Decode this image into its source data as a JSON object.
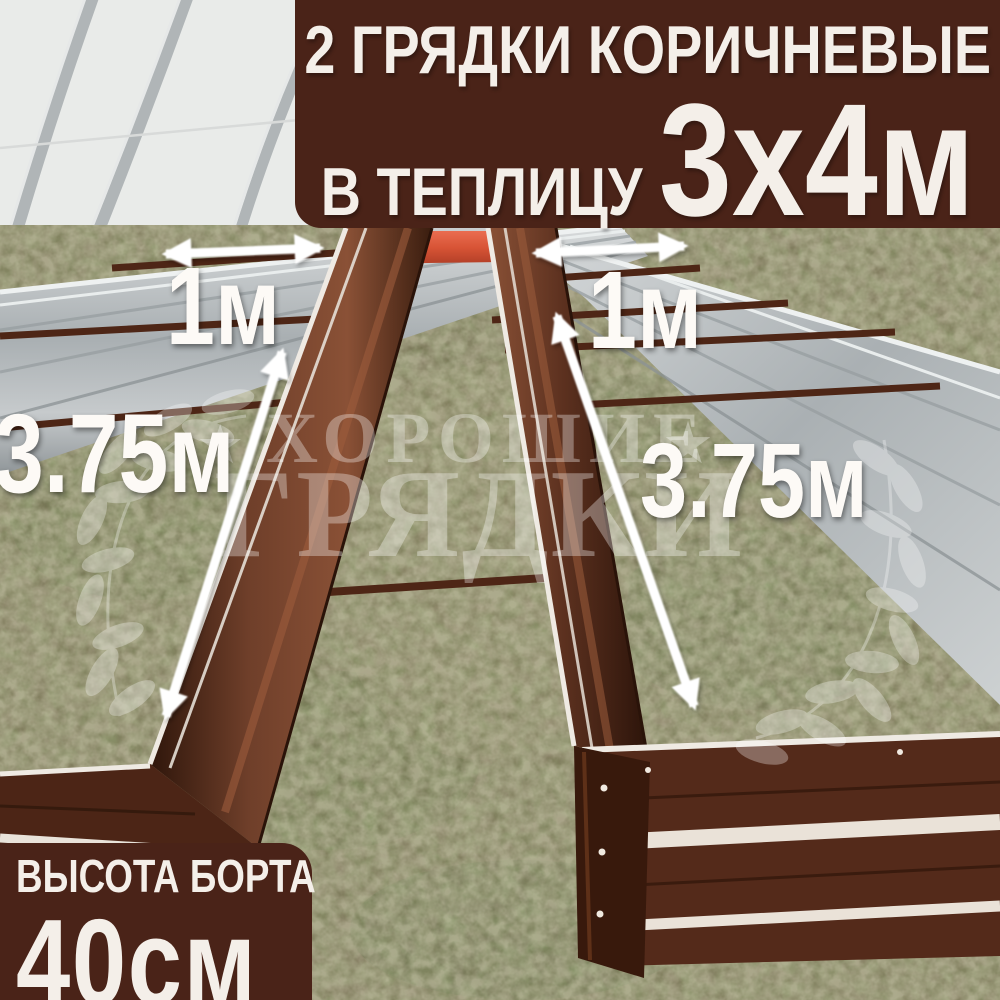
{
  "banner": {
    "line1": "2 ГРЯДКИ КОРИЧНЕВЫЕ",
    "line2_small": "В ТЕПЛИЦУ",
    "line2_big": "3х4м"
  },
  "badge": {
    "title": "ВЫСОТА БОРТА",
    "value": "40см"
  },
  "measurements": {
    "left_bed_width": "1м",
    "right_bed_width": "1м",
    "left_bed_length": "3.75м",
    "right_bed_length": "3.75м"
  },
  "watermark": {
    "word1": "ХОРОШИЕ",
    "word2": "ГРЯДКИ",
    "star": "★"
  },
  "colors": {
    "banner_bg": "#4a2318",
    "banner_text": "#f4efe9",
    "bed_brown_dark": "#572a1c",
    "bed_brown_highlight": "#7c4831",
    "bed_rail_white": "#efeae3",
    "orange_end_board": "#d85436",
    "galvanized_metal": "#b7bcbe",
    "greenhouse_wall": "#e9ebe9",
    "ground_green": "#6e7850",
    "ground_dirt": "#7d7459",
    "arrow": "#ffffff"
  }
}
